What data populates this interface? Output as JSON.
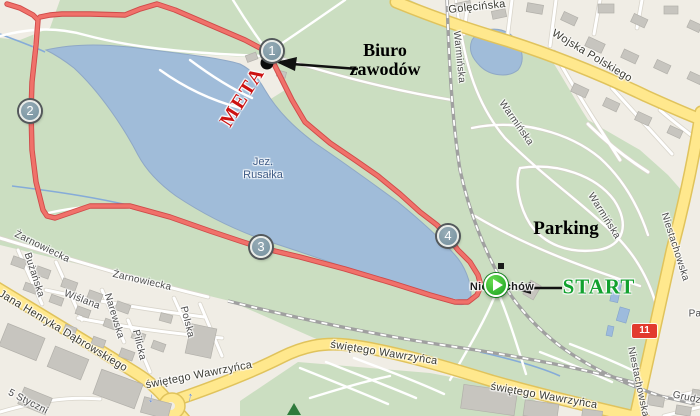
{
  "map": {
    "lake_label": {
      "line1": "Jez.",
      "line2": "Rusałka"
    },
    "place_label": "Niestachów",
    "route_number": "11",
    "checkpoints": {
      "c1": "1",
      "c2": "2",
      "c3": "3",
      "c4": "4"
    },
    "annotations": {
      "race_office_line1": "Biuro",
      "race_office_line2": "zawodów",
      "finish": "META",
      "start": "START",
      "parking": "Parking"
    },
    "streets": {
      "golecinska": "Golęcińska",
      "wojska_polskiego": "Wojska Polskiego",
      "warminska_a": "Warmińska",
      "warminska_b": "Warmińska",
      "warminska_c": "Warmińska",
      "niestachowska_a": "Niestachowska",
      "niestachowska_b": "Niestachowska",
      "zarnowiecka_a": "Żarnowiecka",
      "zarnowiecka_b": "Żarnowiecka",
      "buzanska": "Bużańska",
      "wislana": "Wiślana",
      "narewska": "Narewska",
      "pilicka": "Pilicka",
      "polska": "Polska",
      "dabrowskiego": "Jana Henryka Dąbrowskiego",
      "wawrzynca_a": "świętego Wawrzyńca",
      "wawrzynca_b": "świętego Wawrzyńca",
      "wawrzynca_c": "świętego Wawrzyńca",
      "stycznia": "5 Styczni",
      "grudzieniec": "Grudzi",
      "pa": "Pa"
    },
    "icons": {
      "one_way_down": "↓",
      "one_way_up": "↑"
    },
    "colors": {
      "route_red": "#f0716a",
      "meta_red": "#cc1212",
      "start_green": "#12a12e",
      "road_yellow": "#ffe88d",
      "lake_blue": "#a0bcd9",
      "park_green": "#cbdec1",
      "badge_red": "#e23b2e",
      "checkpoint_fill": "#74909e"
    }
  }
}
